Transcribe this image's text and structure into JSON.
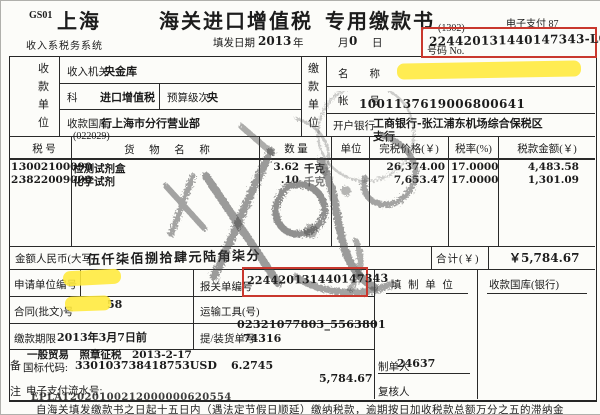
{
  "header": {
    "form_code": "GS01",
    "city": "上海",
    "title_left": "海关进口增值税",
    "title_right": "专用缴款书",
    "bracket_code": "(1302)",
    "epay_flag": "电子支付  87",
    "no_label": "号码  No.",
    "document_no": "224420131440147343-L02",
    "system_label": "收入系税务系统",
    "fill_date_label": "填发日期",
    "fill_year": "2013",
    "year_char": "年",
    "month_char": "月",
    "day_digit": "0",
    "day_char": "日"
  },
  "payee": {
    "block_label": "收款单位",
    "income_agency_label": "收入机关",
    "income_agency_value": "央金库",
    "subject_label": "科",
    "subject_value": "进口增值税",
    "budget_level_label": "预算级次",
    "budget_level_value": "央",
    "treasury_label": "收款国库",
    "treasury_value": "行上海市分行营业部"
  },
  "payer": {
    "block_label": "缴款单位",
    "name_label": "名　　称",
    "account_label": "帐　　号",
    "account_value": "1001137619006800641",
    "bank_label": "开户银行",
    "bank_value_line1": "工商银行-张江浦东机场综合保税区",
    "bank_value_line2": "支行"
  },
  "goods": {
    "headers": [
      "税  号",
      "货 物 名 称",
      "数  量",
      "单位",
      "完税价格(￥)",
      "税率(%)",
      "税款金额(￥)"
    ],
    "annotation": "(022029)",
    "rows": [
      {
        "no": "1.",
        "tax_no": "3002100090",
        "name": "检测试剂盒",
        "qty": "3.62",
        "unit": "千克",
        "price": "26,374.00",
        "rate": "17.0000",
        "amount": "4,483.58"
      },
      {
        "no": "2.",
        "tax_no": "3822009000",
        "name": "化学试剂",
        "qty": ".10",
        "unit": "千克",
        "price": "7,653.47",
        "rate": "17.0000",
        "amount": "1,301.09"
      }
    ]
  },
  "amount_row": {
    "label": "金额人民币(大写",
    "capital_amount": "伍仟柒佰捌拾肆元陆角柒分",
    "total_label": "合计(￥)",
    "total_value": "￥5,784.67"
  },
  "bottom": {
    "applicant_label": "申请单位编号",
    "declaration_label": "报关单编号",
    "declaration_no": "224420131440147343",
    "contract_label": "合同(批文)号",
    "contract_visible": "58",
    "transport_label": "运输工具(号)",
    "deadline_label": "缴款期限",
    "deadline_value": "2013年3月7日前",
    "lading_label": "提/装货单号",
    "lading_no_line1": "02321077803_5563801",
    "lading_no_line2": "74316",
    "fill_unit_label": "填  制  单  位",
    "treasury_bank_label": "收款国库(银行)",
    "preparer_label": "制单人",
    "preparer_value": "24637",
    "reviewer_label": "复核人"
  },
  "remarks": {
    "block_label": "备注",
    "line1": "一般贸易　照章征税　2013-2-17",
    "code_label": "国标代码:",
    "code_value": "330103738418753USD",
    "exchange_rate": "6.2745",
    "amount": "5,784.67",
    "epay_label": "电子支付流水号:",
    "epay_serial": "EPLAT2020100212000000620554"
  },
  "footer": {
    "fine_print": "自海关填发缴款书之日起十五日内（遇法定节假日顺延）缴纳税款，逾期按日加收税款总额万分之五的滞纳金"
  },
  "colors": {
    "highlight_yellow": "#ffe93a",
    "annotation_red": "#c9382e",
    "ink_black": "#1c1c1c",
    "stamp_gray": "#4a4a4a",
    "paper": "#fcfcf9"
  }
}
